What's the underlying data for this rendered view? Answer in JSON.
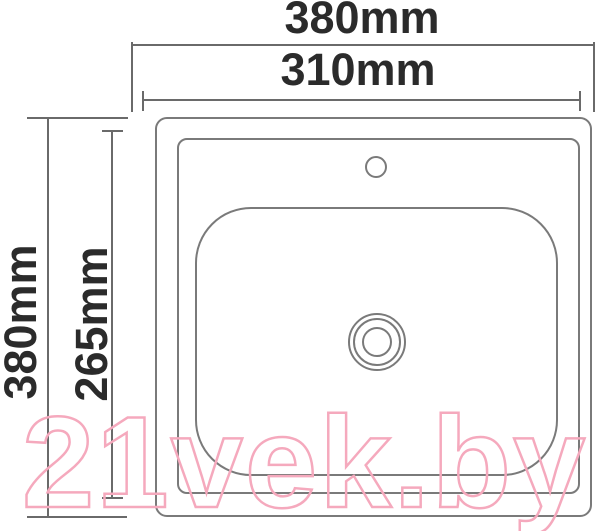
{
  "dimensions": {
    "top_outer_label": "380mm",
    "top_inner_label": "310mm",
    "left_outer_label": "380mm",
    "left_inner_label": "265mm"
  },
  "watermark": {
    "text": "21vek.by",
    "color": "#f5a9bd"
  },
  "colors": {
    "background": "#ffffff",
    "dimension_lines": "#6a6a6a",
    "drawing_outline": "#7a7a7a",
    "label_text": "#2b2b2b"
  }
}
